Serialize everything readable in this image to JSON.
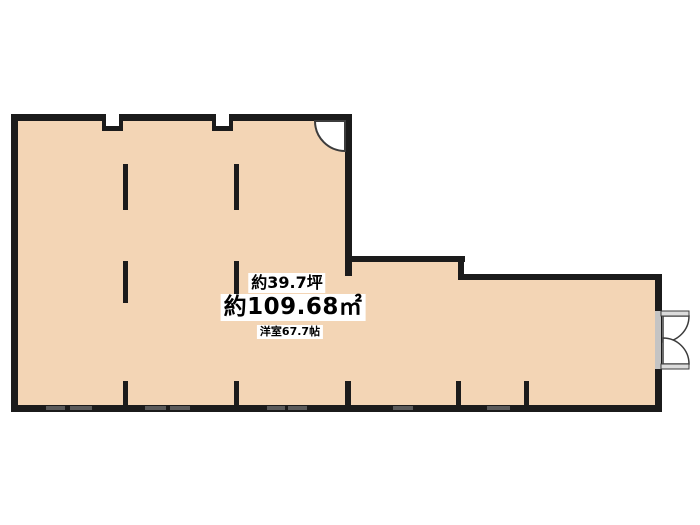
{
  "plan": {
    "labels": {
      "area_tsubo": "約39.7坪",
      "area_sqm": "約109.68㎡",
      "room_size": "洋室67.7帖"
    },
    "colors": {
      "page_background": "#ffffff",
      "floor": "#f3d5b5",
      "wall": "#1b1b1b",
      "window_mark": "#5a5a5a",
      "door_swing_fill": "#ffffff",
      "door_outline": "#3c3c3c",
      "door_leaf": "#dcdcdc",
      "door_opening": "#c4c4c4",
      "label_background": "#ffffff",
      "label_text": "#000000"
    }
  }
}
